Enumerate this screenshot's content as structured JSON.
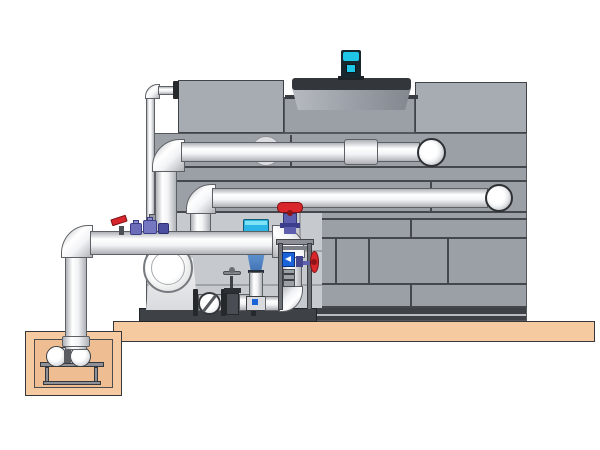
{
  "diagram": {
    "kind": "technical-illustration",
    "subject": "cooling-tower-pump-system",
    "components": [
      "cooling-tower",
      "tower-panel-grid",
      "fan-shroud",
      "fan-motor",
      "hot-water-return-pipe",
      "upper-distribution-pipe",
      "suction-manifold",
      "discharge-riser",
      "secondary-riser",
      "make-up-pipe",
      "pump-skid",
      "centrifugal-pump",
      "check-valve",
      "gate-valve",
      "strainer-funnel",
      "red-handwheel-valve",
      "level-column",
      "flow-indicator",
      "side-handwheel-valve",
      "lever-valve",
      "dosing-pumps",
      "sump-pit",
      "sump-pump",
      "sump-discharge-pipe",
      "concrete-slab"
    ]
  },
  "colors": {
    "background": "#ffffff",
    "tower_panel": "#9ba0a7",
    "tower_panel_light": "#c6c9cd",
    "tower_panel_top": "#a7acb3",
    "tower_seam": "#44474c",
    "tower_base": "#3e4145",
    "tower_dark_top": "#33373b",
    "ground_slab": "#f6caa0",
    "pit_inner": "#efbd92",
    "ground_outline": "#35373a",
    "pipe_light": "#f2f3f5",
    "pipe_edge": "#aeb1b6",
    "pipe_outline": "#5d6064",
    "steel": "#8d9197",
    "dark_flange": "#26292c",
    "motor_cyan": "#1fc6e8",
    "strainer_cyan": "#2ab5e6",
    "cone_blue": "#3f6fb4",
    "valve_red": "#d8262c",
    "valve_red_dark": "#8f1216",
    "valve_purple": "#5d5fae",
    "valve_purple_dark": "#3c3e8c",
    "flow_blue": "#1a63d8",
    "pump_white": "#eceded"
  }
}
